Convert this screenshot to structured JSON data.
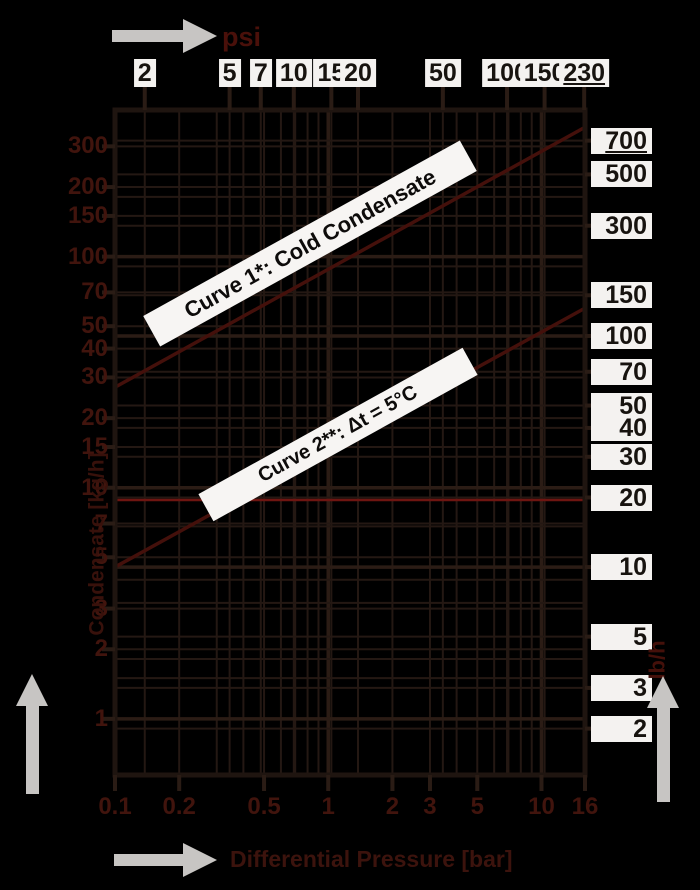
{
  "chart_data": {
    "type": "line",
    "title": "Steam trap condensate capacity chart",
    "x_axis": {
      "scale": "log",
      "unit_top": "psi",
      "ticks_psi": [
        2,
        5,
        7,
        10,
        15,
        20,
        50,
        100,
        150,
        230
      ],
      "underlined_psi_tick": "230",
      "label_bottom": "Differential Pressure [bar]",
      "unit_bottom": "bar",
      "range_bar": [
        0.1,
        16
      ],
      "ticks_bar": [
        "0.1",
        "0.2",
        "0.5",
        "1",
        "2",
        "3",
        "5",
        "10",
        "16"
      ]
    },
    "y_axis": {
      "scale": "log",
      "unit_right": "lb/h",
      "ticks_lbh": [
        700,
        500,
        300,
        150,
        100,
        70,
        50,
        40,
        30,
        20,
        10,
        5,
        3,
        2
      ],
      "underlined_lbh_tick": "700",
      "label_left": "Condensate [kg/h]",
      "unit_left": "kg/h",
      "ticks_kgh": [
        300,
        200,
        150,
        100,
        70,
        50,
        40,
        30,
        20,
        15,
        10,
        7,
        5,
        3,
        2,
        1
      ],
      "range_lbh": [
        1.26,
        950
      ]
    },
    "series": [
      {
        "name": "Curve 1*: Cold Condensate",
        "points_bar_lbh": [
          [
            0.1,
            60
          ],
          [
            16,
            800
          ]
        ]
      },
      {
        "name": "Curve 2**: Δt = 5°C",
        "points_bar_lbh": [
          [
            0.1,
            10
          ],
          [
            16,
            132
          ]
        ]
      }
    ],
    "reference_line_lbh": 19.5,
    "grid": {
      "x_bar_major": [
        0.1,
        1,
        10
      ],
      "x_bar_minor": [
        0.2,
        0.3,
        0.4,
        0.5,
        0.6,
        0.7,
        0.8,
        0.9,
        2,
        3,
        4,
        5,
        6,
        7,
        8,
        9
      ],
      "y_lbh_major": [
        10,
        100
      ],
      "y_lbh_minor": [
        2,
        3,
        4,
        5,
        7,
        15,
        20,
        30,
        40,
        50,
        70,
        150,
        200,
        300,
        400,
        500,
        700
      ],
      "y_kgh_major": [
        1,
        10,
        100
      ],
      "y_kgh_minor": [
        1.5,
        2,
        3,
        4,
        5,
        7,
        15,
        20,
        30,
        40,
        50,
        70,
        150,
        200,
        300
      ]
    },
    "legend_position": "none",
    "grid_on": true
  },
  "colors": {
    "background": "#000000",
    "grid_minor": "#241813",
    "grid_major": "#2b1c15",
    "plot_border": "#1f1510",
    "tick_mark": "#2a1c15",
    "red_reference_line": "#6e1511",
    "curve_line": "#44100b",
    "arrow_gray": "#c7c5c3",
    "dark_red_text": "#41140d",
    "white_label_bg": "#f4f2f0",
    "white_label_text": "#17130f",
    "banner_bg": "#f7f5f3",
    "banner_text": "#0d0b0a"
  }
}
